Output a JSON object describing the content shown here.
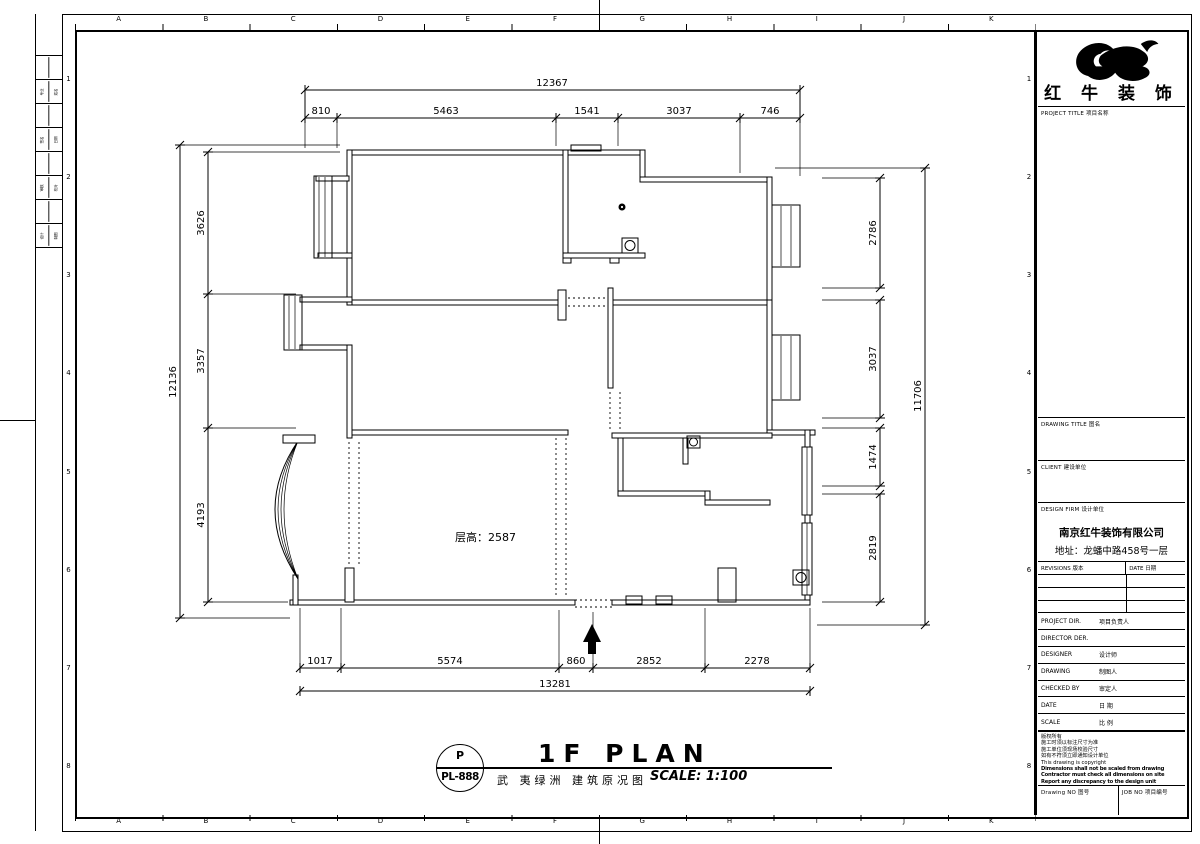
{
  "sheet": {
    "grid_letters": [
      "A",
      "B",
      "C",
      "D",
      "E",
      "F",
      "G",
      "H",
      "I",
      "J",
      "K"
    ],
    "grid_numbers": [
      "1",
      "2",
      "3",
      "4",
      "5",
      "6",
      "7",
      "8"
    ],
    "fold_strip_cells": [
      "专业",
      "姓名",
      "签名",
      "日期",
      "审核",
      "校对",
      "设计",
      "制图"
    ]
  },
  "plan": {
    "floor_height_label": "层高：2587",
    "dims": {
      "top": {
        "total": "12367",
        "segments": [
          "810",
          "5463",
          "1541",
          "3037",
          "746"
        ]
      },
      "bottom": {
        "total": "13281",
        "segments": [
          "1017",
          "5574",
          "860",
          "2852",
          "2278"
        ]
      },
      "left": {
        "total": "12136",
        "segments": [
          "3626",
          "3357",
          "4193"
        ]
      },
      "right": {
        "total": "11706",
        "segments": [
          "2786",
          "3037",
          "1474",
          "2819"
        ]
      }
    }
  },
  "title_bar": {
    "code_top": "P",
    "code": "PL-888",
    "title": "1F PLAN",
    "subtitle": "武 夷绿洲 建筑原况图",
    "scale_label": "SCALE: 1:100"
  },
  "title_block": {
    "brand": "红 牛 装 饰",
    "project_title_label": "PROJECT TITLE 项目名称",
    "drawing_title_label": "DRAWING TITLE 图名",
    "client_label": "CLIENT 建设单位",
    "design_firm_label": "DESIGN FIRM 设计单位",
    "design_firm_name": "南京红牛装饰有限公司",
    "design_firm_address": "地址：龙蟠中路458号一层",
    "revisions_label": "REVISIONS 版本",
    "revision_date_label": "DATE 日期",
    "personnel_rows": [
      {
        "en": "PROJECT DIR.",
        "cn": "项目负责人"
      },
      {
        "en": "DIRECTOR DER.",
        "cn": ""
      },
      {
        "en": "DESIGNER",
        "cn": "设计师"
      },
      {
        "en": "DRAWING",
        "cn": "制图人"
      },
      {
        "en": "CHECKED BY",
        "cn": "审定人"
      },
      {
        "en": "DATE",
        "cn": "日 期"
      },
      {
        "en": "SCALE",
        "cn": "比 例"
      }
    ],
    "notes": [
      "版权所有",
      "施工时须以标注尺寸为准",
      "施工单位须现场校验尺寸",
      "如有不符须立即通知设计单位",
      "This drawing is copyright",
      "Dimensions shall not be scaled from drawing",
      "Contractor must check all dimensions on site",
      "Report any discrepancy to the design unit"
    ],
    "drawing_no_label": "Drawing NO 图号",
    "job_no_label": "JOB NO 项目编号"
  },
  "colors": {
    "line": "#000000",
    "paper": "#ffffff"
  }
}
